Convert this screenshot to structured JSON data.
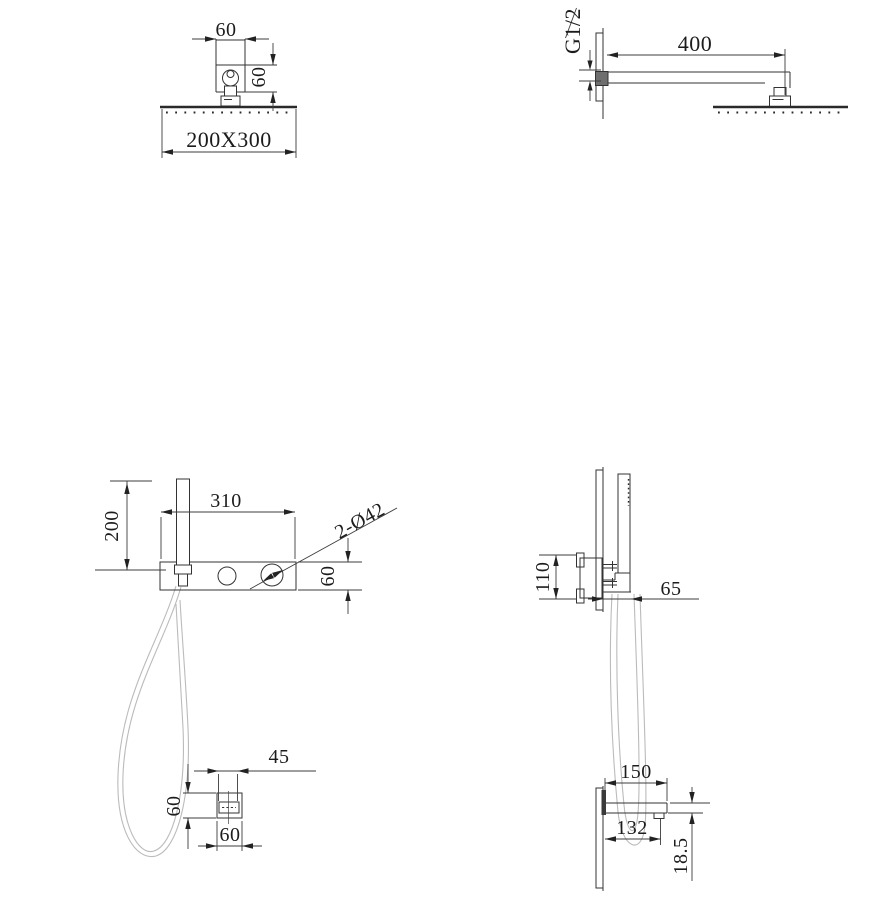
{
  "drawing": {
    "overhead_front": {
      "top_width": "60",
      "side_height": "60",
      "plate_size": "200X300"
    },
    "arm_side": {
      "thread": "G1/2",
      "arm_length": "400"
    },
    "mixer_front": {
      "handle_height": "200",
      "plate_width": "310",
      "hole_callout": "2-Ø42",
      "plate_height": "60"
    },
    "mixer_side": {
      "valve_height": "110",
      "plate_depth": "65"
    },
    "bracket_front": {
      "clip_width": "45",
      "side_height": "60",
      "bottom_width": "60"
    },
    "spout_side": {
      "spout_length": "150",
      "nozzle_offset": "132",
      "spout_height": "18.5"
    }
  },
  "colors": {
    "line": "#333333",
    "hose": "#bbbbbb",
    "background": "#ffffff"
  }
}
